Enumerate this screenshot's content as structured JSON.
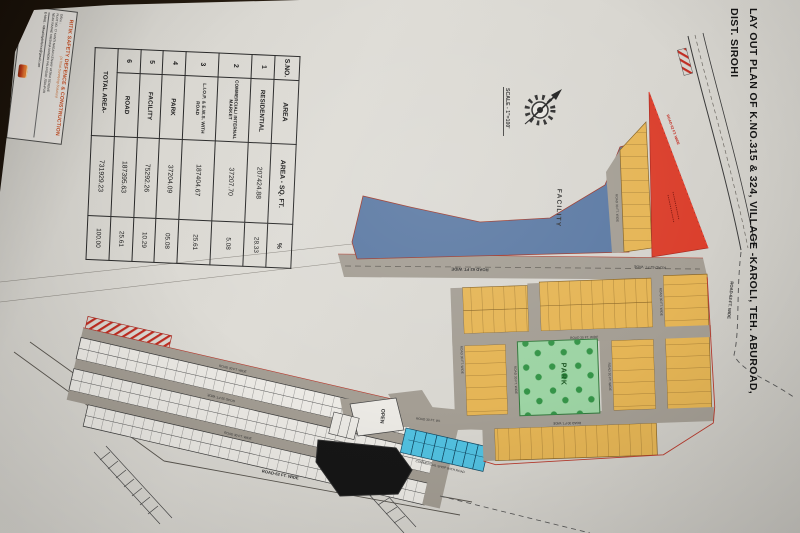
{
  "document": {
    "title_line1": "LAY OUT PLAN OF K.NO.315 & 324, VILLAGE -KAROLI, TEH. ABUROAD,",
    "title_line2": "DIST. SIROHI",
    "scale_label": "SCALE - 1\"=100'"
  },
  "stamp": {
    "company_name": "RITIK SAFETY DEFENCE & CONSTRUCTION",
    "tagline": "(A Total Surveying Solution)",
    "office_label": "Office :",
    "address_line1": "PLOT NO. 77 KANTI NAGAR KESHAV VATIKA SCHEME",
    "address_line2": "NEAR RADHE KRISHNA MANDIR PALI ROAD JODHPUR",
    "email_line": "E-MAIL : ritiksafetydefence@gmail.com"
  },
  "area_table": {
    "headers": [
      "S.NO.",
      "AREA",
      "AREA - SQ. FT.",
      "%"
    ],
    "rows": [
      [
        "1",
        "RESIDENTIAL",
        "207424.88",
        "28.33"
      ],
      [
        "2",
        "COMMERCIAL/ INTERNAL MARKET",
        "37207.70",
        "5.08"
      ],
      [
        "3",
        "L.I.O.P. & E.W.S. WITH ROAD",
        "187404.67",
        "25.61"
      ],
      [
        "4",
        "PARK",
        "37204.09",
        "05.08"
      ],
      [
        "5",
        "FACILITY",
        "75292.26",
        "10.29"
      ],
      [
        "6",
        "ROAD",
        "187395.63",
        "25.61"
      ]
    ],
    "total_label": "TOTAL AREA-",
    "total_area": "731929.23",
    "total_percent": "100.00"
  },
  "plan": {
    "facility_label": "FACILITY",
    "park_label": "PARK",
    "open_label": "OPEN",
    "road_62_main": "ROAD 62 FT. WIDE",
    "road_62_right": "ROAD-62-FT. WIDE",
    "road_62_red": "ROAD 62 FT. WIDE",
    "road_60_left": "ROAD-60-FT. WIDE",
    "road_62_bottom": "ROAD-62 FT. WIDE",
    "road_30": "ROAD 30 FT. WIDE",
    "commercial_note": "COMMERCIAL SHOP WITH ROAD"
  },
  "colors": {
    "residential_yellow": "#e9b54d",
    "facility_blue": "#5a7aa8",
    "commercial_red": "#e63c28",
    "park_green": "#9ad5a1",
    "shops_cyan": "#4ac4e6",
    "road_gray": "#a49e93",
    "boundary_red": "#c0392b"
  }
}
